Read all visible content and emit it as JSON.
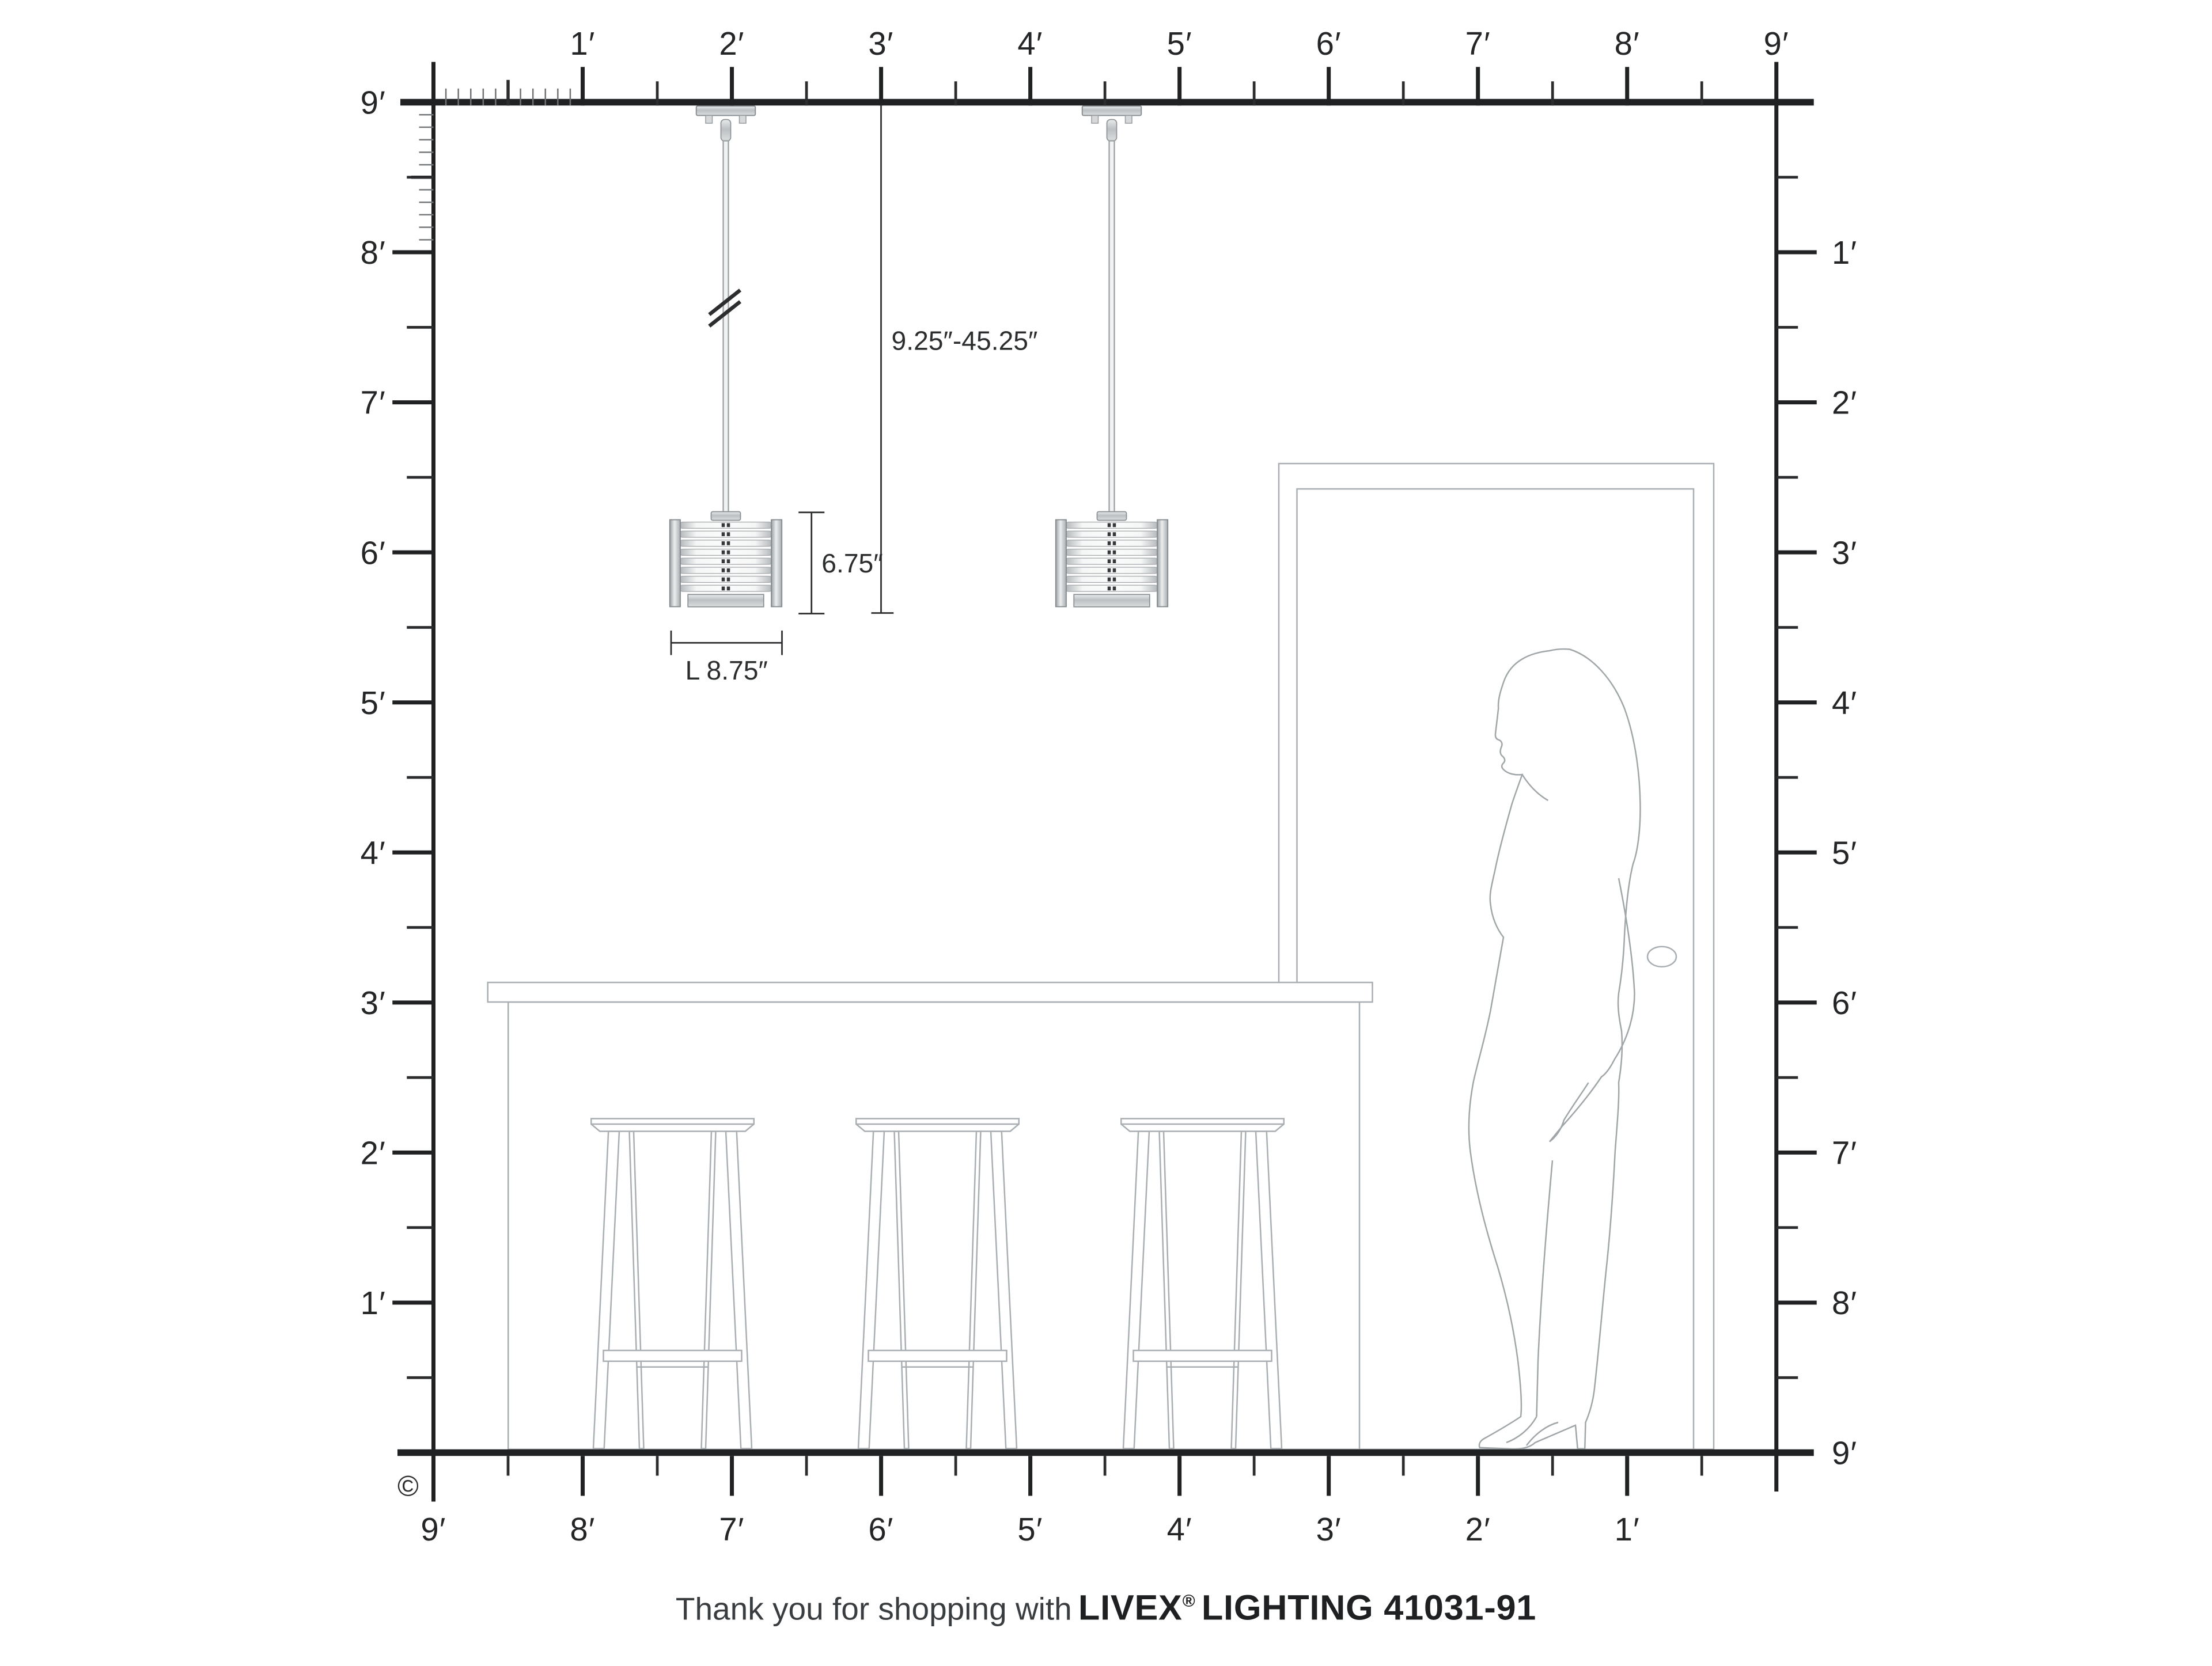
{
  "diagram": {
    "rulers": {
      "top": [
        "1′",
        "2′",
        "3′",
        "4′",
        "5′",
        "6′",
        "7′",
        "8′",
        "9′"
      ],
      "left": [
        "9′",
        "8′",
        "7′",
        "6′",
        "5′",
        "4′",
        "3′",
        "2′",
        "1′"
      ],
      "right": [
        "1′",
        "2′",
        "3′",
        "4′",
        "5′",
        "6′",
        "7′",
        "8′",
        "9′"
      ],
      "bottom": [
        "9′",
        "8′",
        "7′",
        "6′",
        "5′",
        "4′",
        "3′",
        "2′",
        "1′"
      ]
    },
    "dimensions": {
      "hang_range": "9.25″-45.25″",
      "fixture_height": "6.75″",
      "fixture_length": "L 8.75″"
    },
    "footer": {
      "prefix": "Thank you for shopping with",
      "brand": "LIVEX",
      "registered": "®",
      "product": "LIGHTING 41031-91"
    },
    "copyright": "©",
    "colors": {
      "ruler": "#1f2123",
      "furniture_line": "#a9aeb2",
      "dimension_line": "#2b2d2e",
      "silver_light": "#f0f1f2",
      "silver_mid": "#c7cacc",
      "silver_dark": "#8e9296",
      "text": "#232527"
    }
  }
}
